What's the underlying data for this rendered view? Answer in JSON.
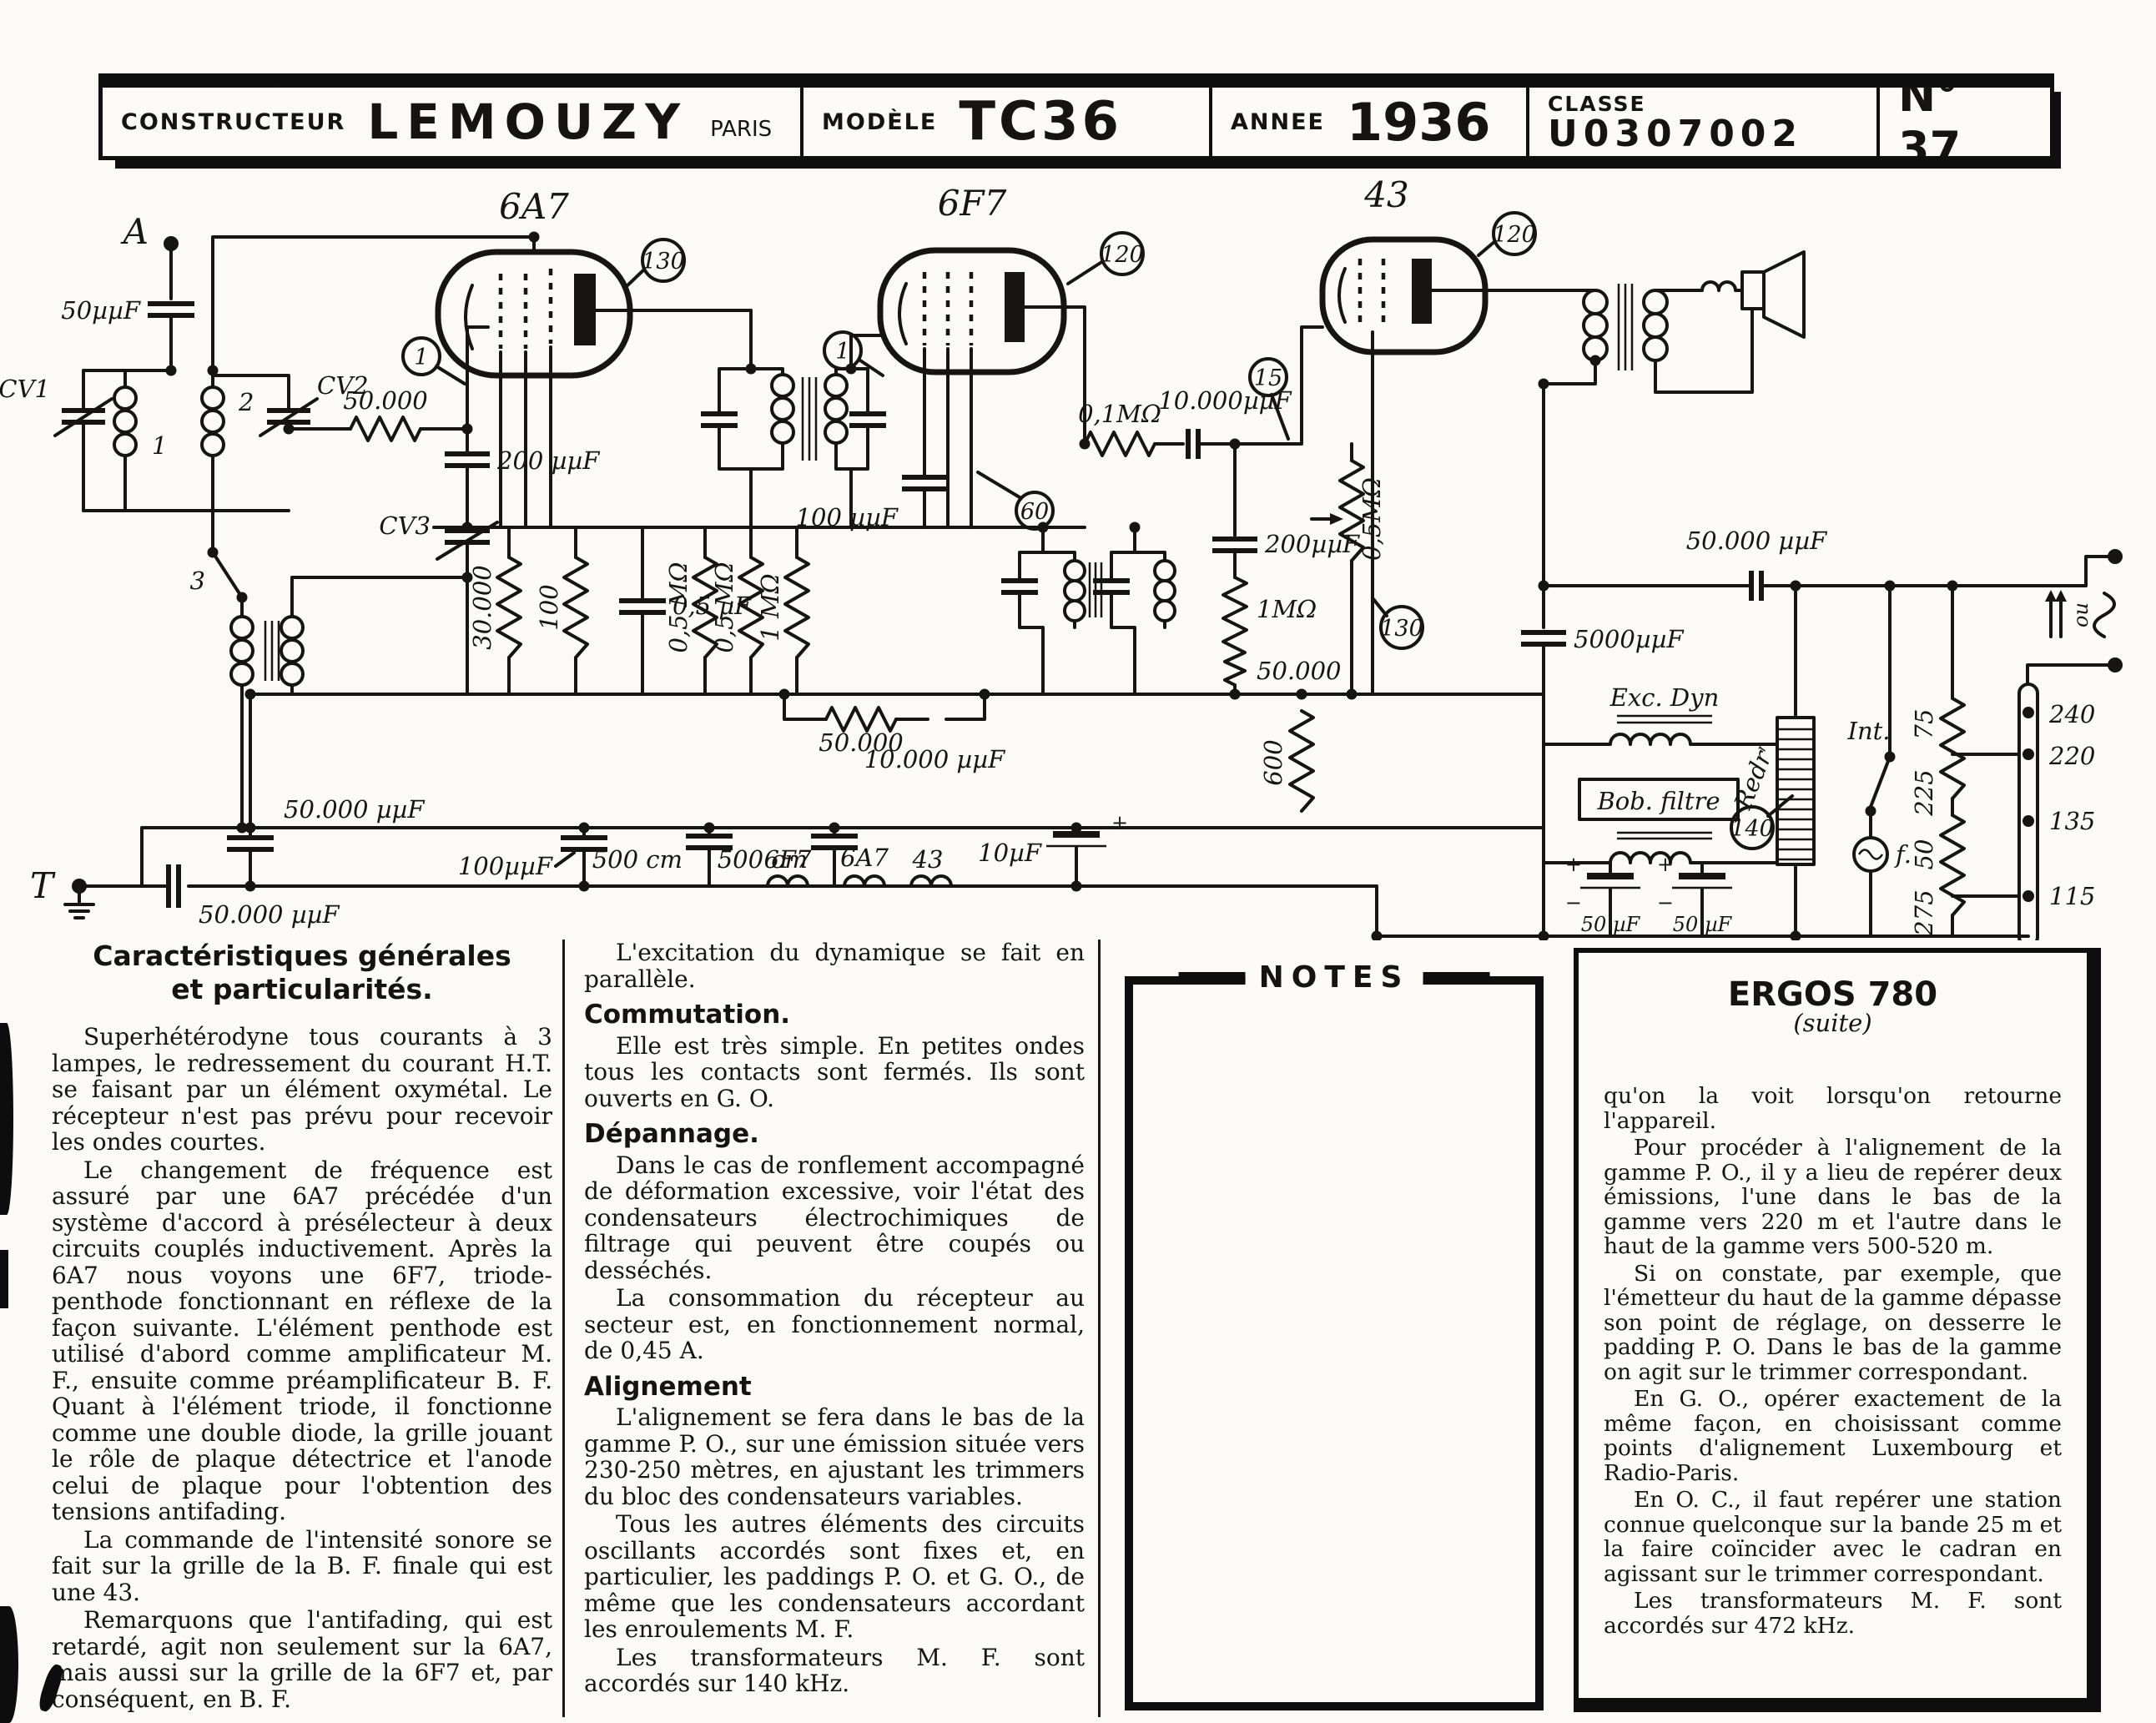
{
  "header": {
    "constructeur_label": "CONSTRUCTEUR",
    "constructeur_value": "LEMOUZY",
    "constructeur_city": "PARIS",
    "modele_label": "MODÈLE",
    "modele_value": "TC36",
    "annee_label": "ANNEE",
    "annee_value": "1936",
    "classe_label": "CLASSE",
    "classe_value": "U0307002",
    "numero": "N° 37"
  },
  "schematic": {
    "labels": {
      "A": "A",
      "cap_a": "50µµF",
      "cv1": "CV1",
      "coil1": "1",
      "coil2": "2",
      "cv2": "CV2",
      "r50k_a": "50.000",
      "c200_a": "200 µµF",
      "cv3": "CV3",
      "sw3": "3",
      "t6a7": "6A7",
      "n1a": "1",
      "n130a": "130",
      "r30k": "30.000",
      "r100": "100",
      "c05": "0,5 µF",
      "r05Ma": "0,5 MΩ",
      "r05Mb": "0,5 MΩ",
      "r1Ma": "1 MΩ",
      "r50k_b": "50.000",
      "c10k_a": "10.000 µµF",
      "c50k_a": "50.000 µµF",
      "c100a": "100µµF",
      "T": "T",
      "c50k_T": "50.000 µµF",
      "c500a": "500 cm",
      "c500b": "500 cm",
      "c10uF": "10µF",
      "fil1": "6F7",
      "fil2": "6A7",
      "fil3": "43",
      "t6f7": "6F7",
      "n1b": "1",
      "n120a": "120",
      "n60": "60",
      "c100b": "100 µµF",
      "r01M": "0,1MΩ",
      "c10k_b": "10.000µµF",
      "n15": "15",
      "c200_b": "200µµF",
      "r1Mb": "1MΩ",
      "r50k_c": "50.000",
      "r600": "600",
      "t43": "43",
      "n120b": "120",
      "r05Mc": "0,5MΩ",
      "n130b": "130",
      "c5000": "5000µµF",
      "c50k_b": "50.000 µµF",
      "excdyn": "Exc. Dyn",
      "bobfiltre": "Bob. filtre",
      "redr": "Redrʳ",
      "n140": "140",
      "int_sw": "Int.",
      "flamp": "f.",
      "c50a": "50 µF",
      "c50b": "50 µF",
      "plus_a": "+",
      "plus_b": "+",
      "plus_c": "+",
      "minus_a": "−",
      "minus_b": "−",
      "d75": "75",
      "d225": "225",
      "d50": "50",
      "d275": "275",
      "v240": "240",
      "v220": "220",
      "v135": "135",
      "v115": "115",
      "mains_ou": "ou"
    }
  },
  "columns": {
    "col1": {
      "heading1": "Caractéristiques générales",
      "heading2": "et particularités.",
      "p1": "Superhétérodyne tous courants à 3 lampes, le redressement du courant H.T. se faisant par un élément oxymétal. Le récepteur n'est pas prévu pour recevoir les ondes courtes.",
      "p2": "Le changement de fréquence est assuré par une 6A7 précédée d'un système d'accord à présélecteur à deux circuits couplés inductivement. Après la 6A7 nous voyons une 6F7, triode-penthode fonctionnant en réflexe de la façon suivante. L'élément penthode est utilisé d'abord comme amplificateur M. F., ensuite comme préamplificateur B. F. Quant à l'élément triode, il fonctionne comme une double diode, la grille jouant le rôle de plaque détectrice et l'anode celui de plaque pour l'obtention des tensions antifading.",
      "p3": "La commande de l'intensité sonore se fait sur la grille de la B. F. finale qui est une 43.",
      "p4": "Remarquons que l'antifading, qui est retardé, agit non seulement sur la 6A7, mais aussi sur la grille de la 6F7 et, par conséquent, en B. F."
    },
    "col2": {
      "p0": "L'excitation du dynamique se fait en parallèle.",
      "h1": "Commutation.",
      "p1": "Elle est très simple. En petites ondes tous les contacts sont fermés. Ils sont ouverts en G. O.",
      "h2": "Dépannage.",
      "p2": "Dans le cas de ronflement accompagné de déformation excessive, voir l'état des condensateurs électrochimiques de filtrage qui peuvent être coupés ou desséchés.",
      "p3": "La consommation du récepteur au secteur est, en fonctionnement normal, de 0,45 A.",
      "h3": "Alignement",
      "p4": "L'alignement se fera dans le bas de la gamme P. O., sur une émission située vers 230-250 mètres, en ajustant les trimmers du bloc des condensateurs variables.",
      "p5": "Tous les autres éléments des circuits oscillants accordés sont fixes et, en particulier, les paddings P. O. et G. O., de même que les condensateurs accordant les enroulements M. F.",
      "p6": "Les transformateurs M. F. sont accordés sur 140 kHz."
    },
    "notes": {
      "title": "NOTES"
    },
    "ergos": {
      "title": "ERGOS 780",
      "subtitle": "(suite)",
      "p1": "qu'on la voit lorsqu'on retourne l'appareil.",
      "p2": "Pour procéder à l'alignement de la gamme P. O., il y a lieu de repérer deux émissions, l'une dans le bas de la gamme vers 220 m et l'autre dans le haut de la gamme vers 500-520 m.",
      "p3": "Si on constate, par exemple, que l'émetteur du haut de la gamme dépasse son point de réglage, on desserre le padding P. O. Dans le bas de la gamme on agit sur le trimmer correspondant.",
      "p4": "En G. O., opérer exactement de la même façon, en choisissant comme points d'alignement Luxembourg et Radio-Paris.",
      "p5": "En O. C., il faut repérer une station connue quelconque sur la bande 25 m et la faire coïncider avec le cadran en agissant sur le trimmer correspondant.",
      "p6": "Les transformateurs M. F. sont accordés sur 472 kHz."
    }
  }
}
